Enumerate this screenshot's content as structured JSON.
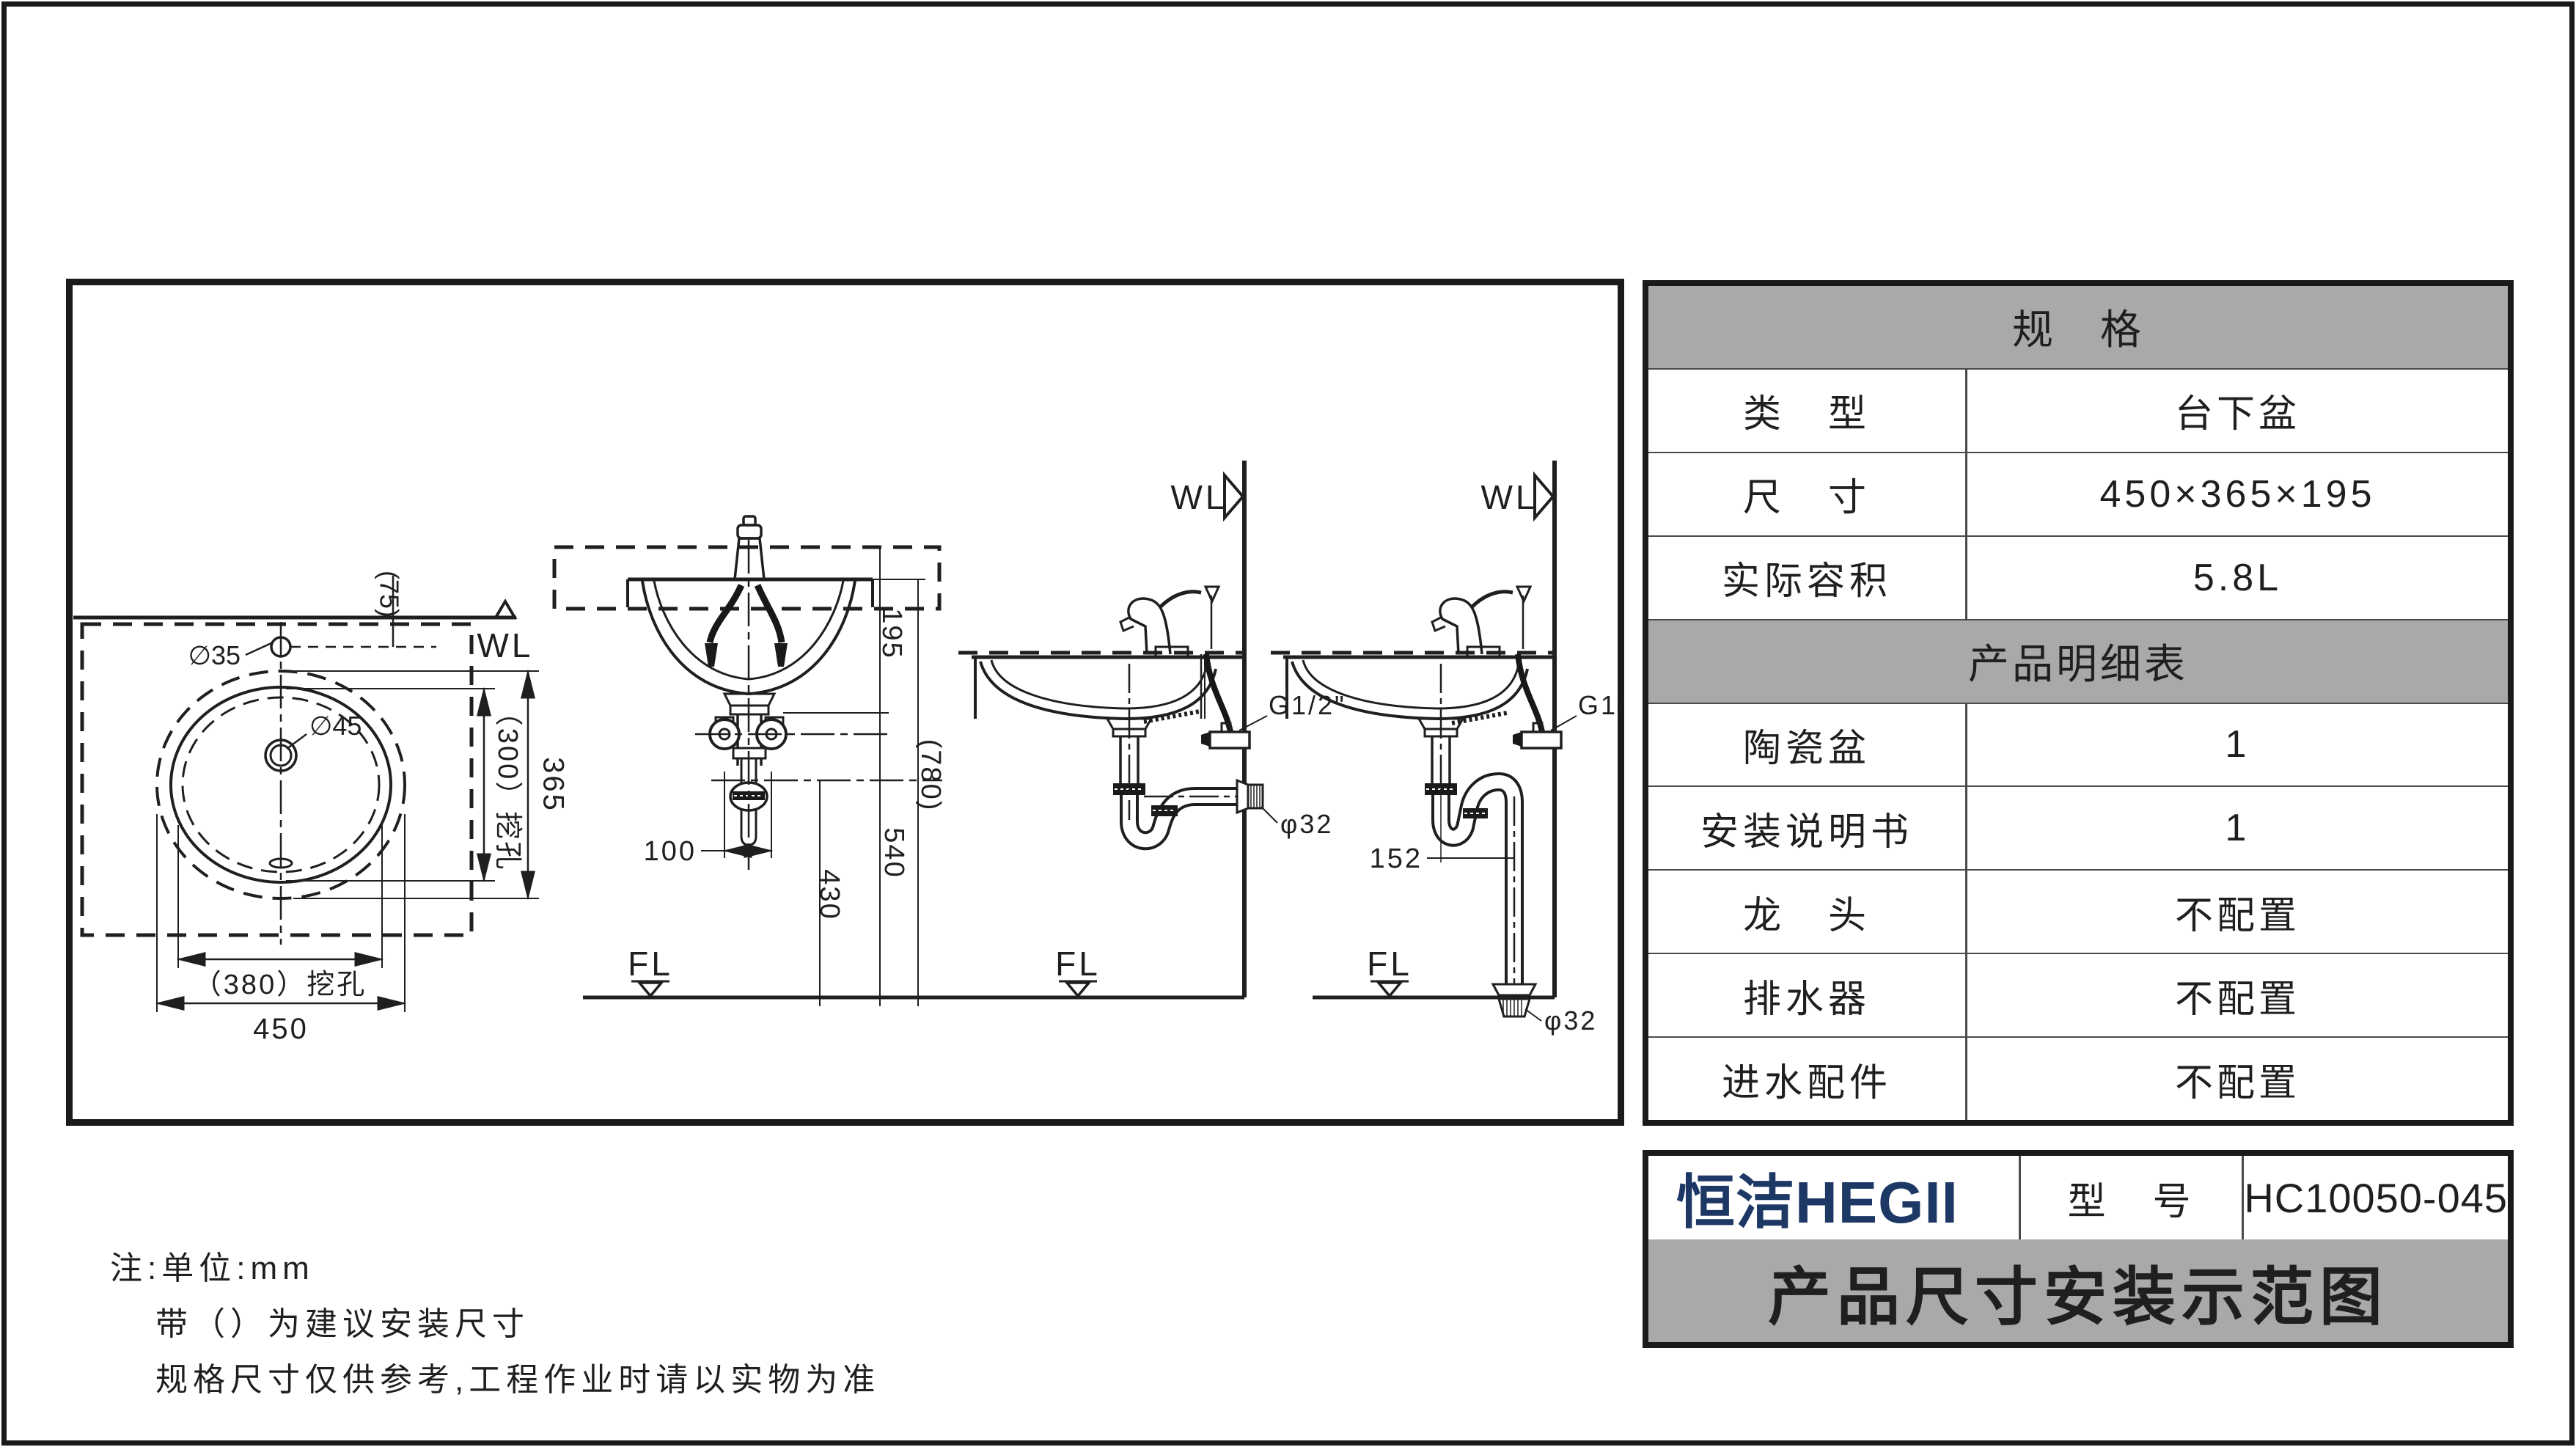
{
  "colors": {
    "line": "#1f1f1f",
    "gray_header": "#a9a9a9",
    "logo_navy": "#1e3866"
  },
  "spec_table": {
    "header1": "规　格",
    "rows1": [
      {
        "label": "类　型",
        "value": "台下盆"
      },
      {
        "label": "尺　寸",
        "value": "450×365×195"
      },
      {
        "label": "实际容积",
        "value": "5.8L"
      }
    ],
    "header2": "产品明细表",
    "rows2": [
      {
        "label": "陶瓷盆",
        "value": "1"
      },
      {
        "label": "安装说明书",
        "value": "1"
      },
      {
        "label": "龙　头",
        "value": "不配置"
      },
      {
        "label": "排水器",
        "value": "不配置"
      },
      {
        "label": "进水配件",
        "value": "不配置"
      }
    ]
  },
  "title_block": {
    "logo": "恒洁HEGII",
    "model_label": "型　号",
    "model_value": "HC10050-045",
    "title": "产品尺寸安装示范图"
  },
  "notes": {
    "line1": "注:单位:mm",
    "line2": "带（）为建议安装尺寸",
    "line3": "规格尺寸仅供参考,工程作业时请以实物为准"
  },
  "drawings": {
    "top_view": {
      "wl": "WL",
      "hole_dia": "∅35",
      "drain_dia": "∅45",
      "offset": "(75)",
      "cut_width": "（300）挖孔",
      "width": "365",
      "cut_length": "（380）挖孔",
      "length": "450"
    },
    "front_view": {
      "depth": "195",
      "counter_height": "(780)",
      "drain_height": "540",
      "trap_height": "430",
      "hole_space": "100",
      "fl": "FL"
    },
    "wall_drain_view": {
      "wl": "WL",
      "fl": "FL",
      "inlet": "G1/2\"",
      "outlet": "φ32"
    },
    "floor_drain_view": {
      "wl": "WL",
      "fl": "FL",
      "inlet": "G1/2\"",
      "outlet": "φ32",
      "offset": "152"
    }
  }
}
